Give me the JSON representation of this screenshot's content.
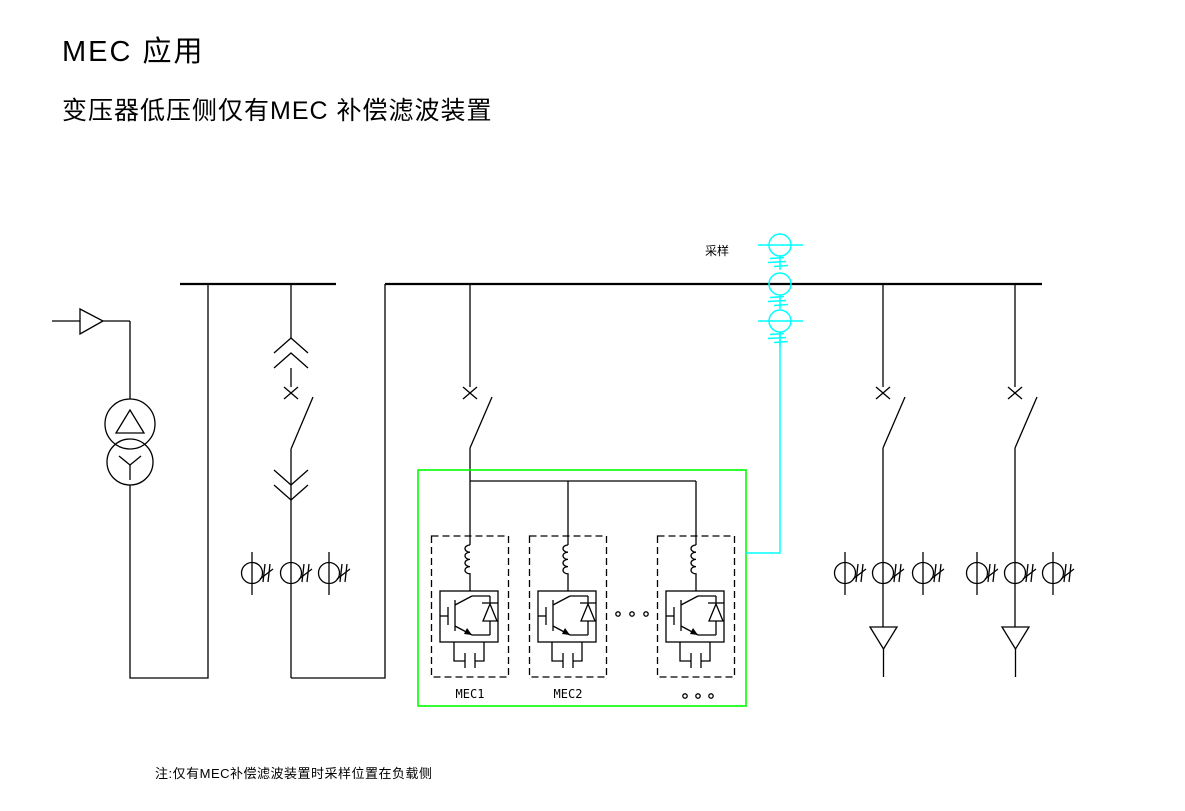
{
  "header": {
    "title": "MEC 应用",
    "subtitle": "变压器低压侧仅有MEC 补偿滤波装置"
  },
  "footer": {
    "note": "注:仅有MEC补偿滤波装置时采样位置在负载侧"
  },
  "labels": {
    "sampling": "采样",
    "mec_modules": [
      "MEC1",
      "MEC2"
    ]
  },
  "colors": {
    "line": "#000000",
    "mec_enclosure": "#00ff00",
    "sampling_circuit": "#00ffff",
    "background": "#ffffff"
  },
  "diagram": {
    "type": "single-line electrical schematic",
    "bus_sections": 2,
    "incoming_transformer": "delta-wye",
    "mec_modules_shown": 3,
    "outgoing_feeders": 2,
    "sampling_cts": 3,
    "feeder_ct_groups": 3
  }
}
